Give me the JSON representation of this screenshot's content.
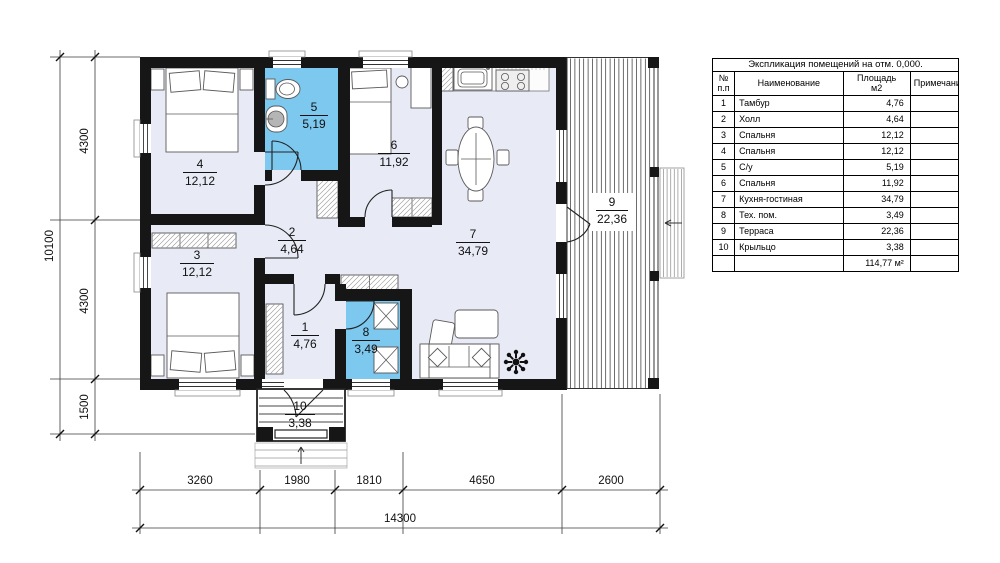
{
  "rooms": [
    {
      "num": "1",
      "name": "Тамбур",
      "area": "4,76"
    },
    {
      "num": "2",
      "name": "Холл",
      "area": "4,64"
    },
    {
      "num": "3",
      "name": "Спальня",
      "area": "12,12"
    },
    {
      "num": "4",
      "name": "Спальня",
      "area": "12,12"
    },
    {
      "num": "5",
      "name": "С/у",
      "area": "5,19"
    },
    {
      "num": "6",
      "name": "Спальня",
      "area": "11,92"
    },
    {
      "num": "7",
      "name": "Кухня-гостиная",
      "area": "34,79"
    },
    {
      "num": "8",
      "name": "Тех. пом.",
      "area": "3,49"
    },
    {
      "num": "9",
      "name": "Терраса",
      "area": "22,36"
    },
    {
      "num": "10",
      "name": "Крыльцо",
      "area": "3,38"
    }
  ],
  "total_area": "114,77 м²",
  "table": {
    "title": "Экспликация помещений на отм. 0,000.",
    "header": {
      "num_line1": "№",
      "num_line2": "п.п",
      "name": "Наименование",
      "area_line1": "Площадь",
      "area_line2": "м2",
      "note": "Примечание"
    }
  },
  "dimensions": {
    "left": {
      "total": "10100",
      "segments": [
        "4300",
        "4300",
        "1500"
      ]
    },
    "bottom": {
      "total": "14300",
      "segments": [
        "3260",
        "1980",
        "1810",
        "4650",
        "2600"
      ]
    }
  },
  "colors": {
    "room_fill": "#e8ebf5",
    "wet_room_fill": "#7cc8ee",
    "wall": "#161616"
  }
}
